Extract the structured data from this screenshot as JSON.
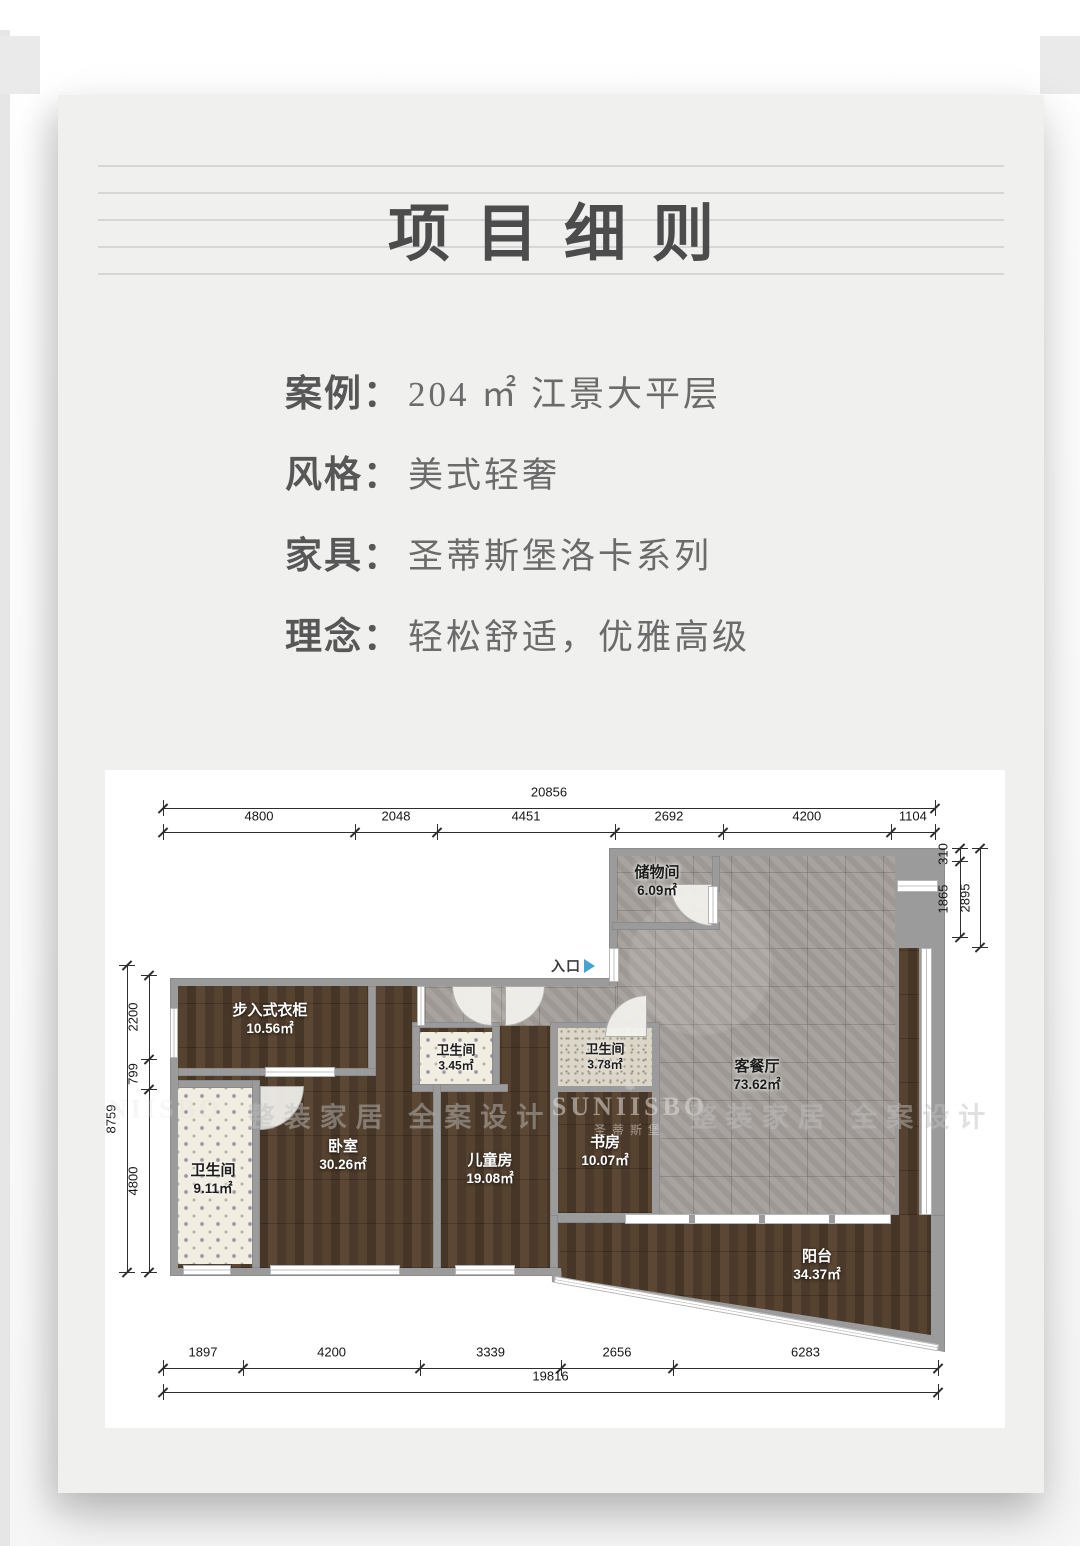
{
  "card": {
    "title": "项目细则"
  },
  "info": [
    {
      "label": "案例：",
      "value": "204 ㎡ 江景大平层"
    },
    {
      "label": "风格：",
      "value": "美式轻奢"
    },
    {
      "label": "家具：",
      "value": "圣蒂斯堡洛卡系列"
    },
    {
      "label": "理念：",
      "value": "轻松舒适，优雅高级"
    }
  ],
  "floorplan": {
    "entrance_label": "入口",
    "watermark": {
      "brand": "SUNIISBO",
      "brand_cn": "圣蒂斯堡",
      "slogan": "整装家居 全案设计",
      "flower_icon": "❁"
    },
    "rooms": {
      "storage": {
        "name": "储物间",
        "area": "6.09㎡"
      },
      "living": {
        "name": "客餐厅",
        "area": "73.62㎡"
      },
      "closet": {
        "name": "步入式衣柜",
        "area": "10.56㎡"
      },
      "bath_master": {
        "name": "卫生间",
        "area": "9.11㎡"
      },
      "bedroom": {
        "name": "卧室",
        "area": "30.26㎡"
      },
      "bath_mid": {
        "name": "卫生间",
        "area": "3.45㎡"
      },
      "kids": {
        "name": "儿童房",
        "area": "19.08㎡"
      },
      "bath_small": {
        "name": "卫生间",
        "area": "3.78㎡"
      },
      "study": {
        "name": "书房",
        "area": "10.07㎡"
      },
      "balcony": {
        "name": "阳台",
        "area": "34.37㎡"
      }
    },
    "dimensions": {
      "top": {
        "total": 20856,
        "segments": [
          4800,
          2048,
          4451,
          2692,
          4200,
          1104
        ]
      },
      "bottom": {
        "total": 19816,
        "segments": [
          1897,
          4200,
          3339,
          2656,
          6283
        ]
      },
      "left": {
        "total": 8759,
        "segments": [
          2200,
          799,
          4800
        ]
      },
      "right": {
        "total": 2895,
        "segments": [
          310,
          1865
        ]
      }
    }
  }
}
